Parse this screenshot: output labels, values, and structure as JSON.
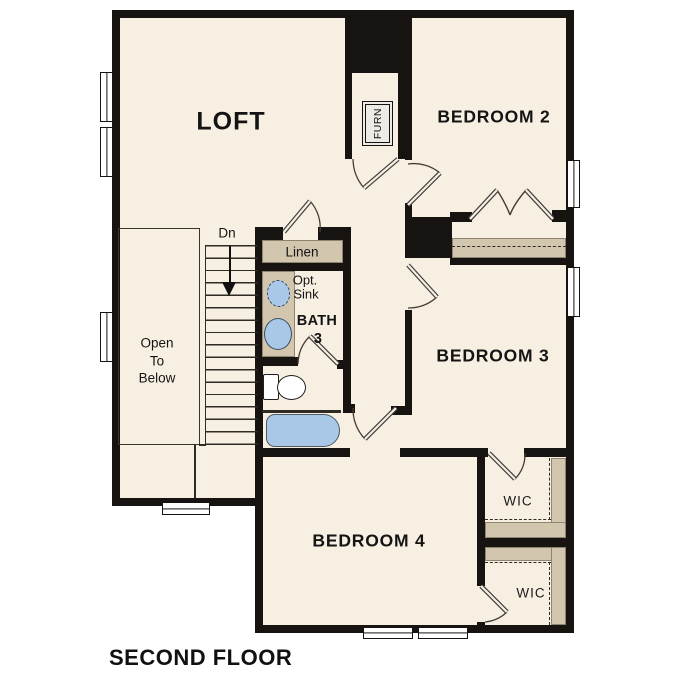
{
  "title": "SECOND FLOOR",
  "rooms": {
    "loft": "LOFT",
    "bedroom2": "BEDROOM 2",
    "bedroom3": "BEDROOM 3",
    "bedroom4": "BEDROOM 4",
    "bath": {
      "name": "BATH",
      "number": "3"
    },
    "wic_upper": "WIC",
    "wic_lower": "WIC"
  },
  "closets": {
    "linen": "Linen",
    "furnace": "FURN"
  },
  "fixtures": {
    "optional_sink": [
      "Opt.",
      "Sink"
    ]
  },
  "stairs": {
    "direction": "Dn",
    "open_to_below": [
      "Open",
      "To",
      "Below"
    ]
  },
  "colors": {
    "floor": "#f7efe1",
    "wall": "#171310",
    "casework": "#d3c6ae",
    "fixture_blue": "#a9c7e6"
  }
}
